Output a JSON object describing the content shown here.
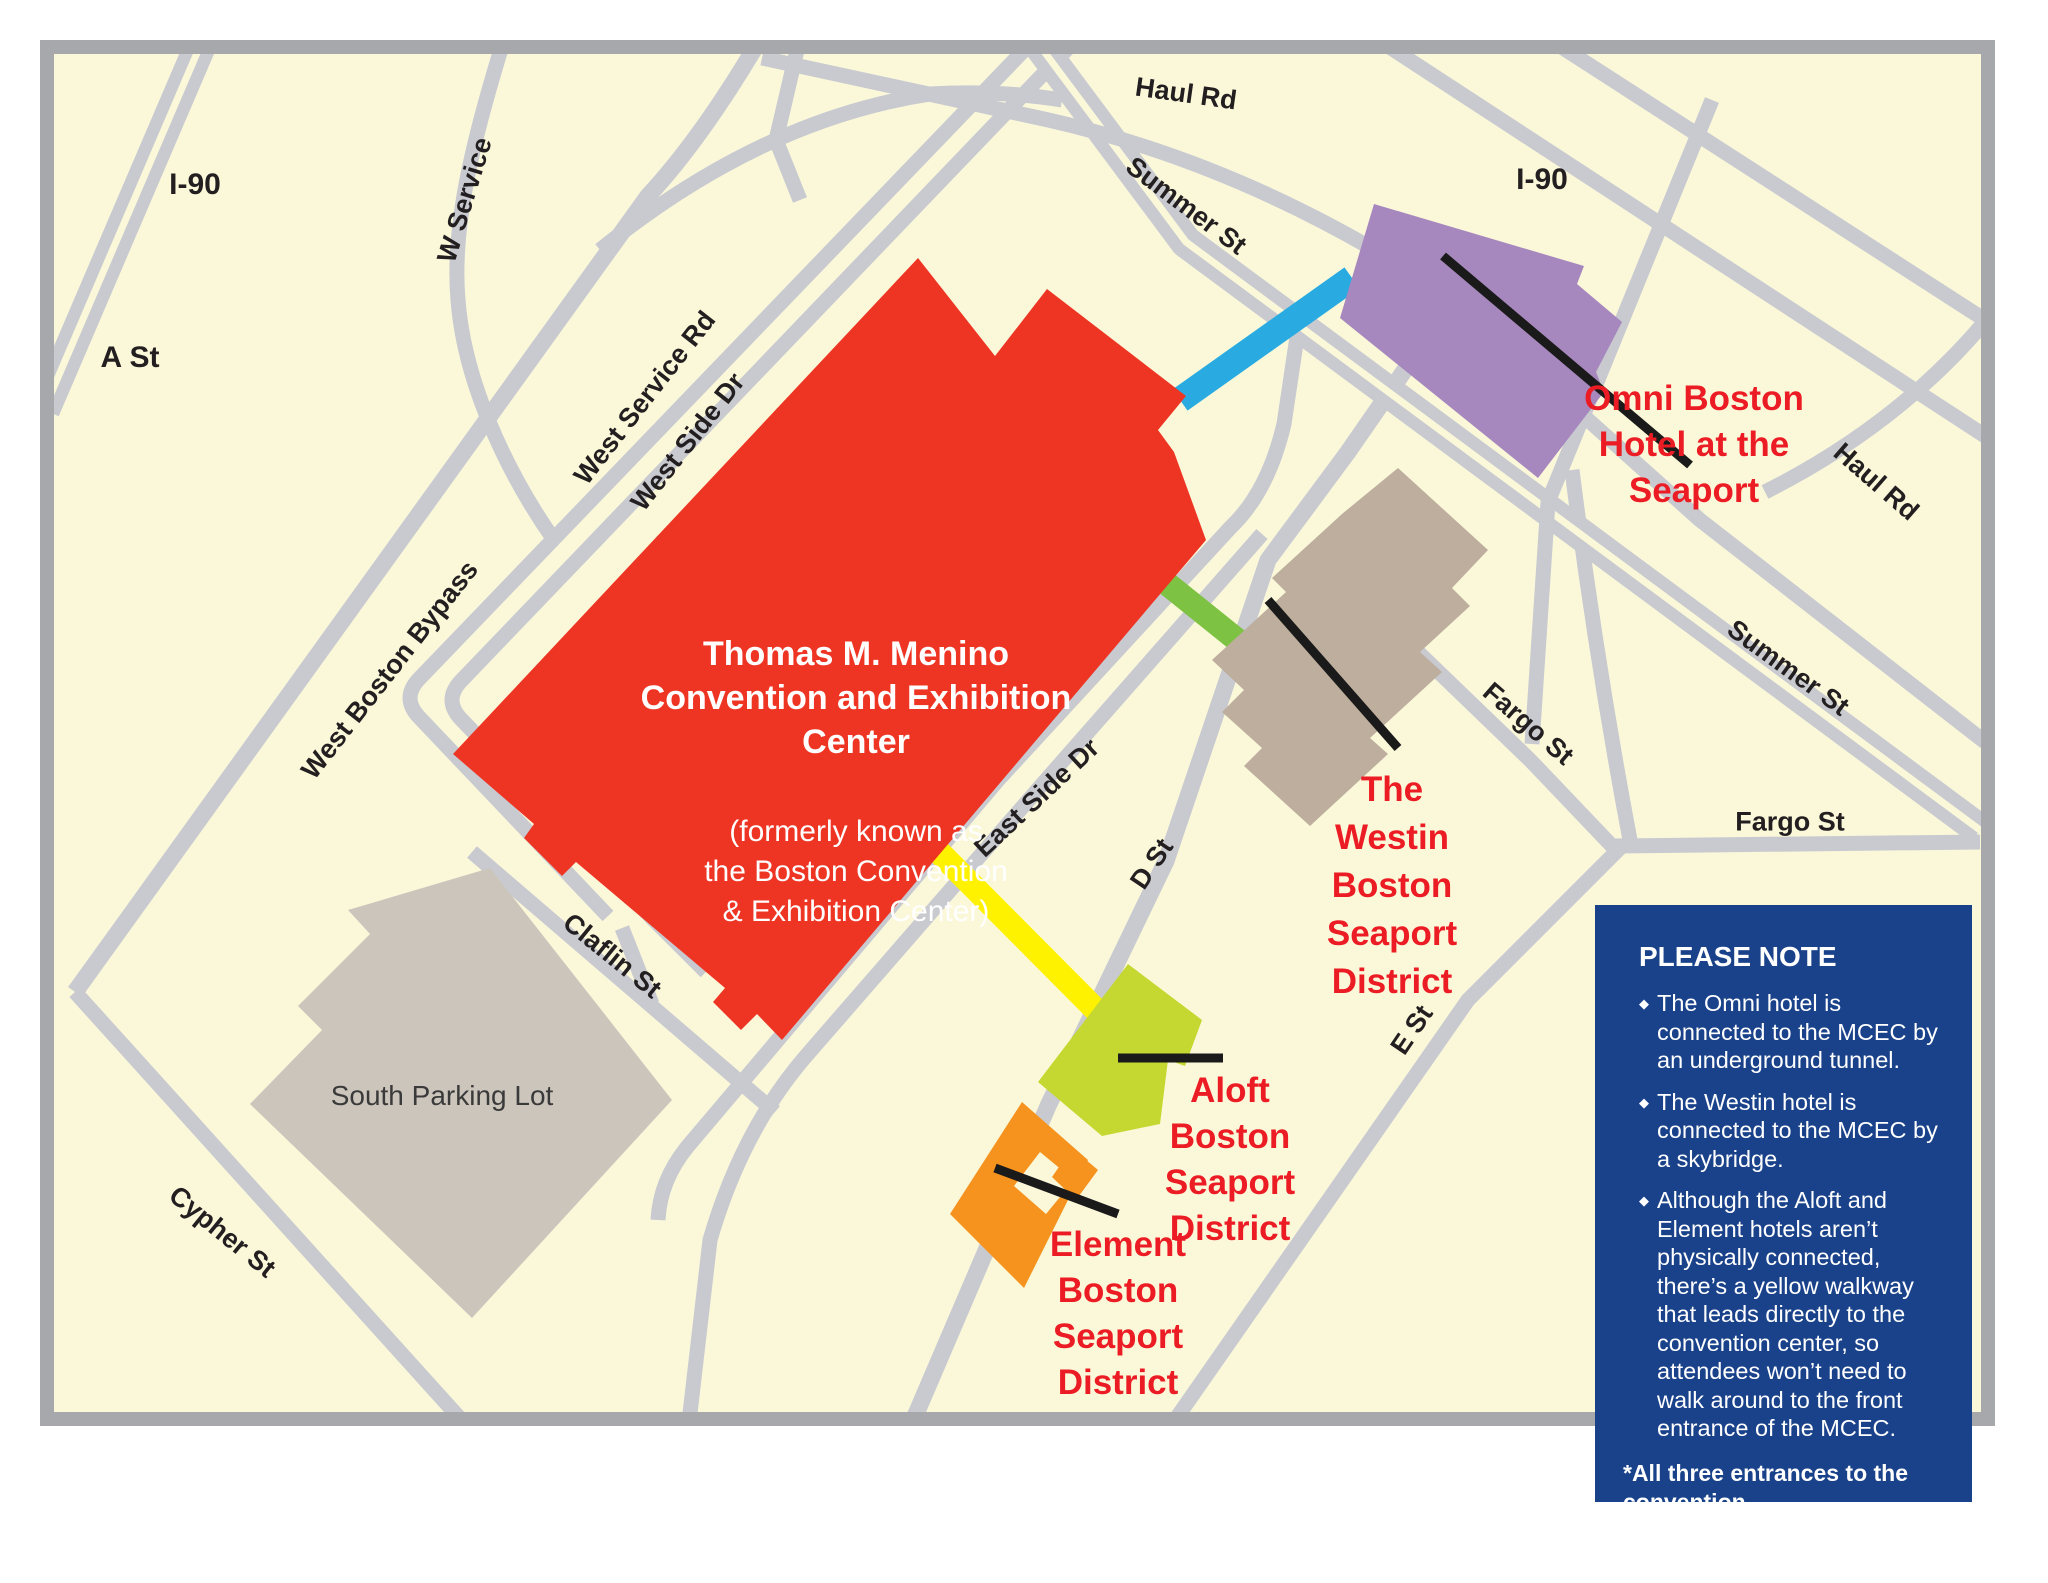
{
  "colors": {
    "map_background": "#FBF8DA",
    "map_border": "#A6A8AB",
    "road_gray": "#C8CAD0",
    "convention_center_red": "#EE3524",
    "omni_purple": "#A788BE",
    "westin_tan": "#BDAE9D",
    "parking_lot_gray": "#CCC5BC",
    "aloft_yellow_green": "#C5D831",
    "element_orange": "#F6921E",
    "walkway_yellow": "#FFF200",
    "tunnel_blue": "#29ABE2",
    "skybridge_green": "#7DC242",
    "note_box_navy": "#1A428A",
    "hotel_label_red": "#EC1C24"
  },
  "map": {
    "convention_center": {
      "title": "Thomas M. Menino\nConvention and Exhibition\nCenter",
      "subtitle": "(formerly known as\nthe Boston Convention\n& Exhibition Center)"
    },
    "areas": {
      "south_parking_lot": "South Parking Lot"
    },
    "road_labels": {
      "i90_left": "I-90",
      "a_st": "A St",
      "w_service": "W Service",
      "west_service_rd": "West Service Rd",
      "west_side_dr": "West Side Dr",
      "west_boston_bypass": "West Boston Bypass",
      "claflin_st": "Claflin St",
      "cypher_st": "Cypher St",
      "east_side_dr": "East Side Dr",
      "d_st": "D St",
      "e_st": "E St",
      "summer_st_top": "Summer St",
      "summer_st_right": "Summer St",
      "haul_rd_top": "Haul Rd",
      "haul_rd_right": "Haul Rd",
      "fargo_st_diag": "Fargo St",
      "fargo_st_horiz": "Fargo St",
      "i90_right": "I-90"
    },
    "hotel_labels": {
      "omni": "Omni Boston\nHotel at the\nSeaport",
      "westin": "The\nWestin\nBoston\nSeaport\nDistrict",
      "aloft": "Aloft\nBoston\nSeaport\nDistrict",
      "element": "Element\nBoston\nSeaport\nDistrict"
    }
  },
  "note_box": {
    "heading": "PLEASE NOTE",
    "bullets": [
      "The Omni hotel is\nconnected to the MCEC by\nan underground tunnel.",
      "The Westin hotel is\nconnected to the MCEC by\na skybridge.",
      "Although the Aloft and\nElement hotels aren’t\nphysically connected,\nthere’s a yellow walkway\nthat leads directly to the\nconvention center, so\nattendees won’t need to\nwalk around to the front\nentrance of the MCEC."
    ],
    "footnote": "*All three entrances to the convention\ncenter will have security checkpoints."
  }
}
